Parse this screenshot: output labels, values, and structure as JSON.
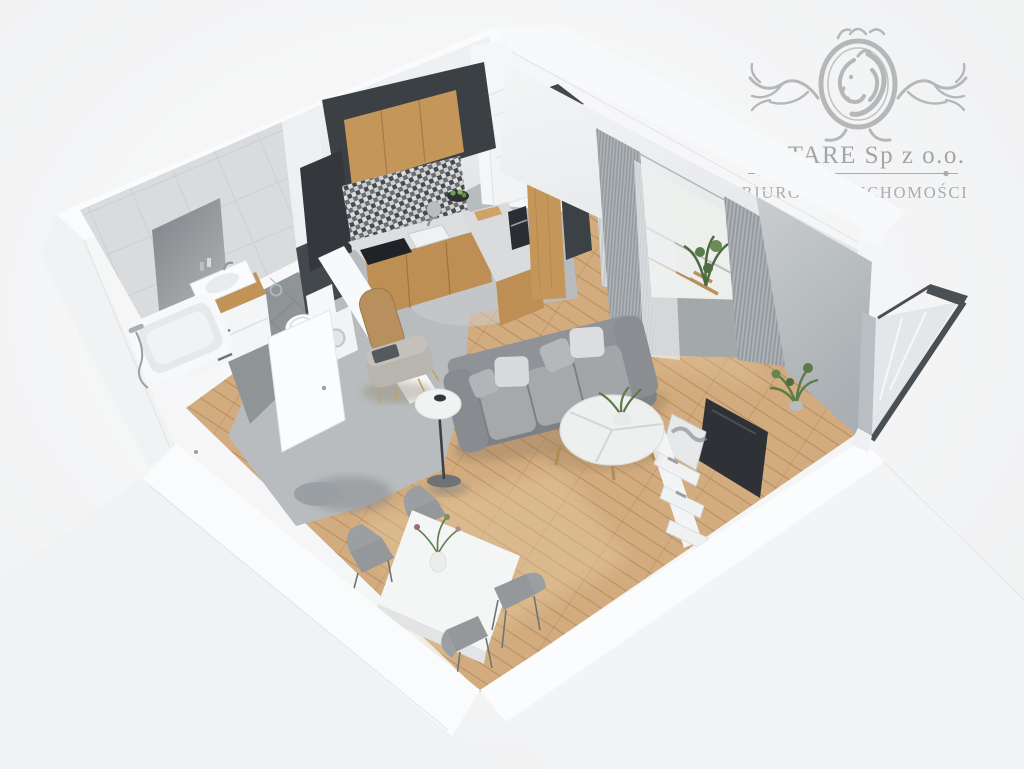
{
  "watermark": {
    "title": "ELITARE Sp z o.o.",
    "subtitle": "BIURO NIERUCHOMOŚCI"
  },
  "scene": {
    "type": "3d-cutaway-floorplan-render",
    "rooms": [
      "bathroom",
      "kitchen",
      "hallway",
      "living-room",
      "dining-area",
      "balcony"
    ],
    "furniture": [
      "bathtub",
      "vanity-sink",
      "mirror",
      "toilet",
      "washing-machine",
      "kitchen-cabinets",
      "tall-cabinet",
      "radiator",
      "sofa",
      "coffee-table",
      "floor-lamp",
      "tv",
      "tv-shelf",
      "bench",
      "round-rug",
      "dining-table",
      "dining-chairs",
      "curtains",
      "corner-plant",
      "corner-window"
    ]
  },
  "palette": {
    "background": "#f3f4f5",
    "wall_white": "#fafbfc",
    "wall_face": "#eef0f1",
    "gray_wall": "#bfc4c7",
    "bath_tile": "#d9dbdc",
    "bath_floor": "#8f9497",
    "concrete": "#b9bcbe",
    "wood_floor": "#d2ac7f",
    "wood_cabinet": "#c49659",
    "kitchen_dark": "#3b4045",
    "counter": "#dcdedf",
    "sofa_body": "#8f9397",
    "sofa_cushion": "#a5a9ac",
    "pillow_white": "#d9dadc",
    "pillow_gray": "#b2b5b8",
    "curtain_gray": "#a8aeb2",
    "sheer_white": "#eef0f2",
    "table_white": "#f4f5f5",
    "chair_gray": "#94989b",
    "bench_taupe": "#b7b5ae",
    "plant_green": "#5d7b4a",
    "lamp_shade": "#f1f2f2",
    "tv_dark": "#2e3236",
    "rug_gray": "#999fa2",
    "logo_gray": "#b5b7b8"
  }
}
